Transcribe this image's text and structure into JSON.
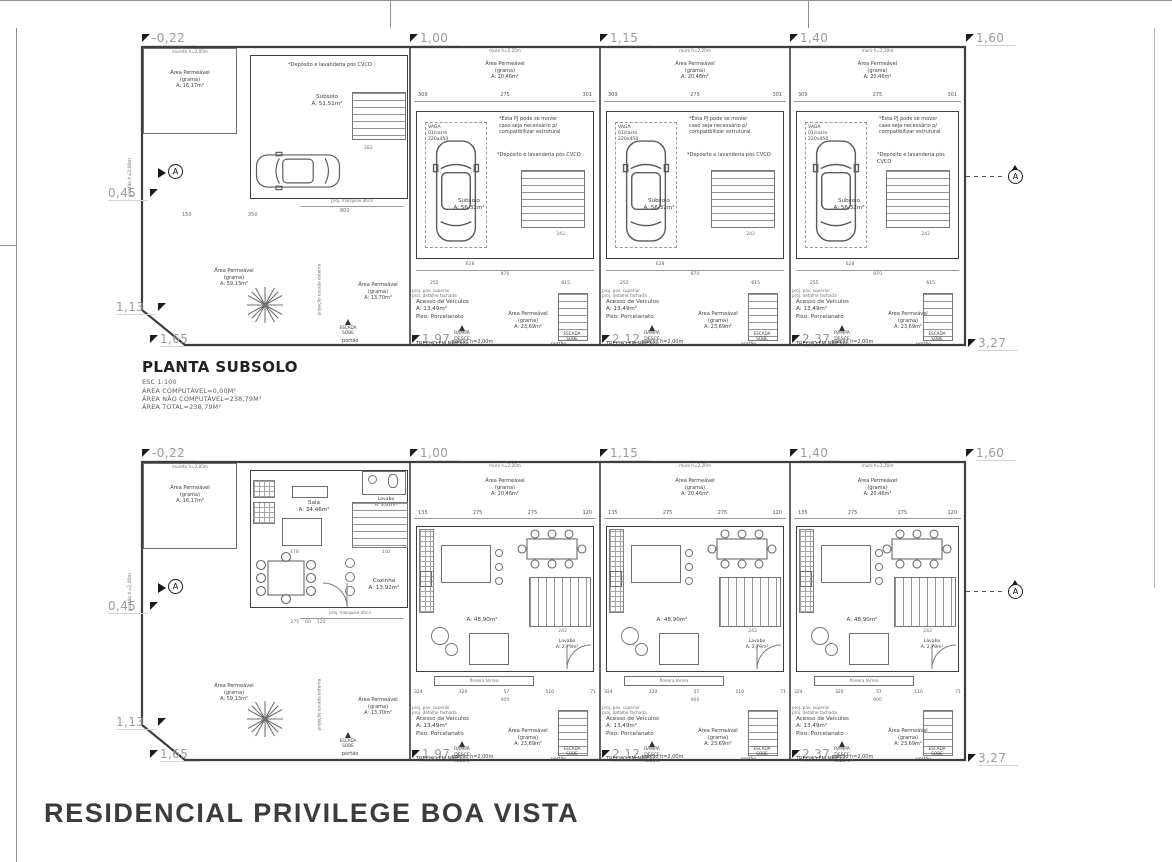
{
  "project_title": "RESIDENCIAL PRIVILEGE BOA VISTA",
  "title_block": {
    "name": "PLANTA SUBSOLO",
    "scale": "ESC 1:100",
    "l1": "ÁREA COMPUTÁVEL=0,00M²",
    "l2": "ÁREA NÃO COMPUTÁVEL=238,79M²",
    "l3": "ÁREA TOTAL=238,79M²"
  },
  "levels": {
    "top": [
      "-0,22",
      "1,00",
      "1,15",
      "1,40",
      "1,60"
    ],
    "left": [
      "0,45",
      "1,13",
      "1,65"
    ],
    "bottom": [
      "1,97",
      "2,12",
      "2,37",
      "3,27"
    ]
  },
  "labels": {
    "muro": "muro h=2,20m",
    "mureta": "mureta h=2,00m",
    "portao_h": "portão h=2,00m",
    "portao": "portão",
    "ap1": "Área Permeável",
    "ap2": "(grama)",
    "subsolo": "Subsolo",
    "sala": "Sala",
    "lavabo": "Lavabo",
    "cozinha": "Cozinha",
    "acesso": "Acesso de Veículos",
    "piso": "Piso:  Porcelanato",
    "rampa": "RAMPA",
    "desce": "DESCE",
    "i25": "i=25%",
    "trecho": "TRECHO EM NÍVEL",
    "escada": "ESCADA",
    "sobe": "SOBE",
    "vaga": "VAGA",
    "vaga2": "01/carro",
    "vaga3": "220x450",
    "floreira": "floreira térrea",
    "proj_pav": "proj. pav. superior",
    "proj_det": "proj. detalhe fachada",
    "proj_marq": "proj. marquise ático",
    "proj_esc": "projeção escada externa",
    "secA": "A"
  },
  "notes": {
    "pj1": "*Esta PJ pode se mover",
    "pj2": "caso seja necessário p/",
    "pj3": "compatibilizar estrutural",
    "cvco": "*Depósito e lavanderia pós CVCO"
  },
  "areas": {
    "perm16": "A: 16,17m²",
    "perm20": "A: 20,46m²",
    "perm23": "A: 23,69m²",
    "perm59": "A: 59,13m²",
    "perm137": "A: 13,70m²",
    "sub1": "A: 51,51m²",
    "sub2": "A: 56,32m²",
    "sala": "A: 34,46m²",
    "lav1": "A: 3,61m²",
    "coz": "A: 13,92m²",
    "living": "A: 48,90m²",
    "lav2": "A: 2,79m²",
    "acesso": "A: 13,49m²"
  },
  "dims": {
    "d309": "309",
    "d275": "275",
    "d301": "301",
    "d628": "628",
    "d870": "870",
    "d255": "255",
    "d615": "615",
    "d150": "150",
    "d350": "350",
    "d800": "800",
    "d282": "282",
    "d242": "242",
    "d135": "135",
    "d120": "120",
    "d324": "324",
    "d320": "320",
    "d57": "57",
    "d110": "110",
    "d71": "71",
    "d900": "900",
    "d478": "478",
    "d102": "102",
    "walk": "275    60    120"
  }
}
